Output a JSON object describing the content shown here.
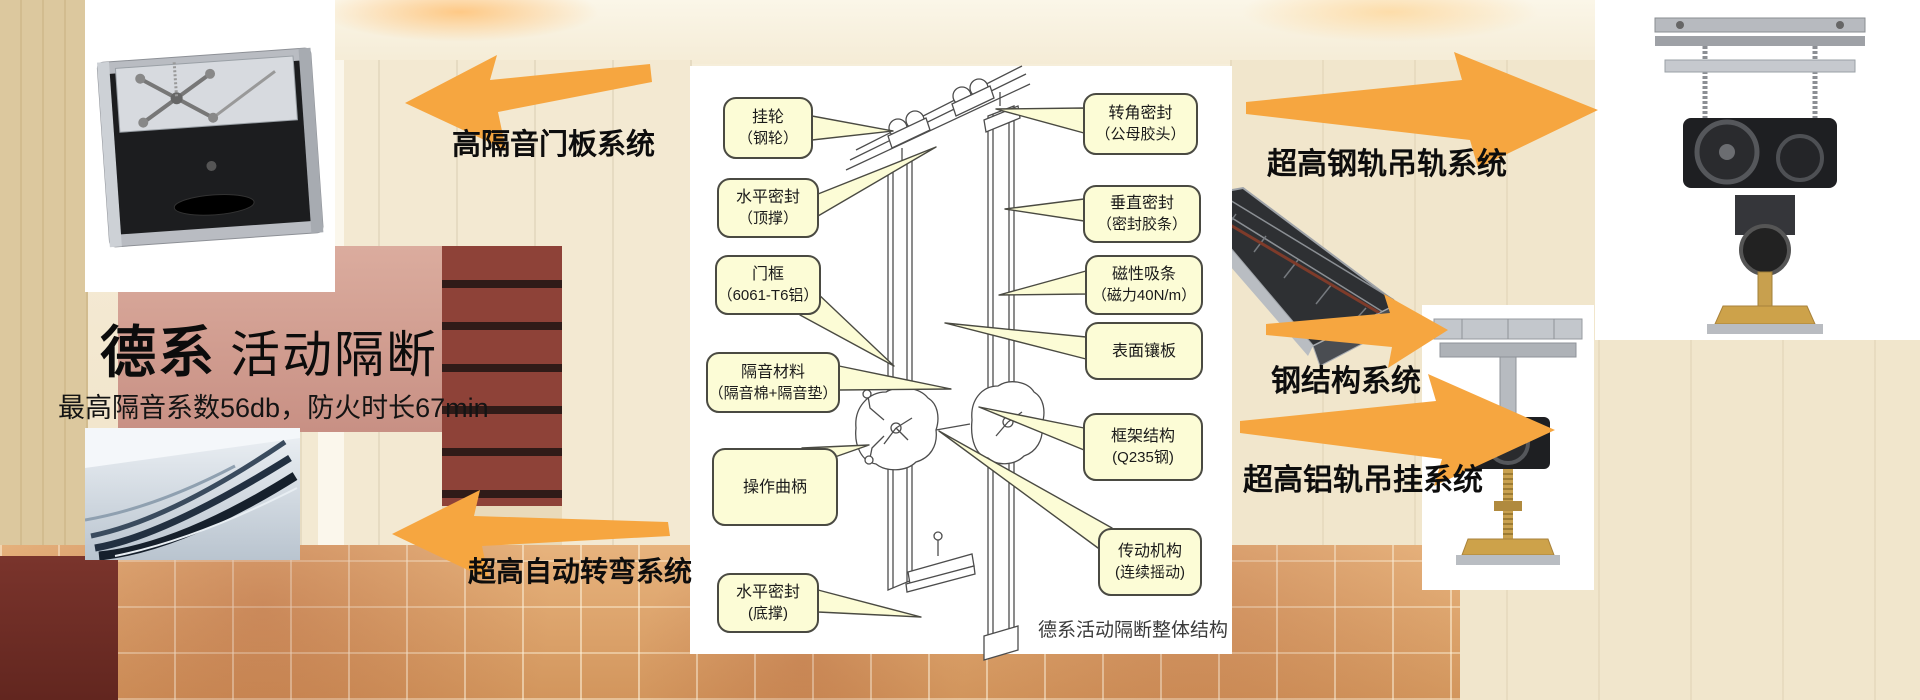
{
  "header": {
    "title_brand": "德系",
    "title_rest": "活动隔断",
    "subtitle": "最高隔音系数56db，防火时长67min"
  },
  "systems": [
    {
      "id": "door-panel",
      "label": "高隔音门板系统"
    },
    {
      "id": "auto-turn",
      "label": "超高自动转弯系统"
    },
    {
      "id": "steel-track",
      "label": "超高钢轨吊轨系统"
    },
    {
      "id": "steel-structure",
      "label": "钢结构系统"
    },
    {
      "id": "alu-track",
      "label": "超高铝轨吊挂系统"
    }
  ],
  "diagram": {
    "caption": "德系活动隔断整体结构",
    "callouts_left": [
      {
        "line1": "挂轮",
        "line2": "（钢轮）"
      },
      {
        "line1": "水平密封",
        "line2": "（顶撑）"
      },
      {
        "line1": "门框",
        "line2": "（6061-T6铝）"
      },
      {
        "line1": "隔音材料",
        "line2": "（隔音棉+隔音垫）"
      },
      {
        "line1": "操作曲柄",
        "line2": ""
      },
      {
        "line1": "水平密封",
        "line2": "(底撑)"
      }
    ],
    "callouts_right": [
      {
        "line1": "转角密封",
        "line2": "（公母胶头）"
      },
      {
        "line1": "垂直密封",
        "line2": "（密封胶条）"
      },
      {
        "line1": "磁性吸条",
        "line2": "（磁力40N/m）"
      },
      {
        "line1": "表面镶板",
        "line2": ""
      },
      {
        "line1": "框架结构",
        "line2": "(Q235钢)"
      },
      {
        "line1": "传动机构",
        "line2": "(连续摇动)"
      }
    ]
  },
  "colors": {
    "arrow": "#F6A640",
    "callout_bg": "#FCFCD6",
    "callout_border": "#4A4A42"
  }
}
